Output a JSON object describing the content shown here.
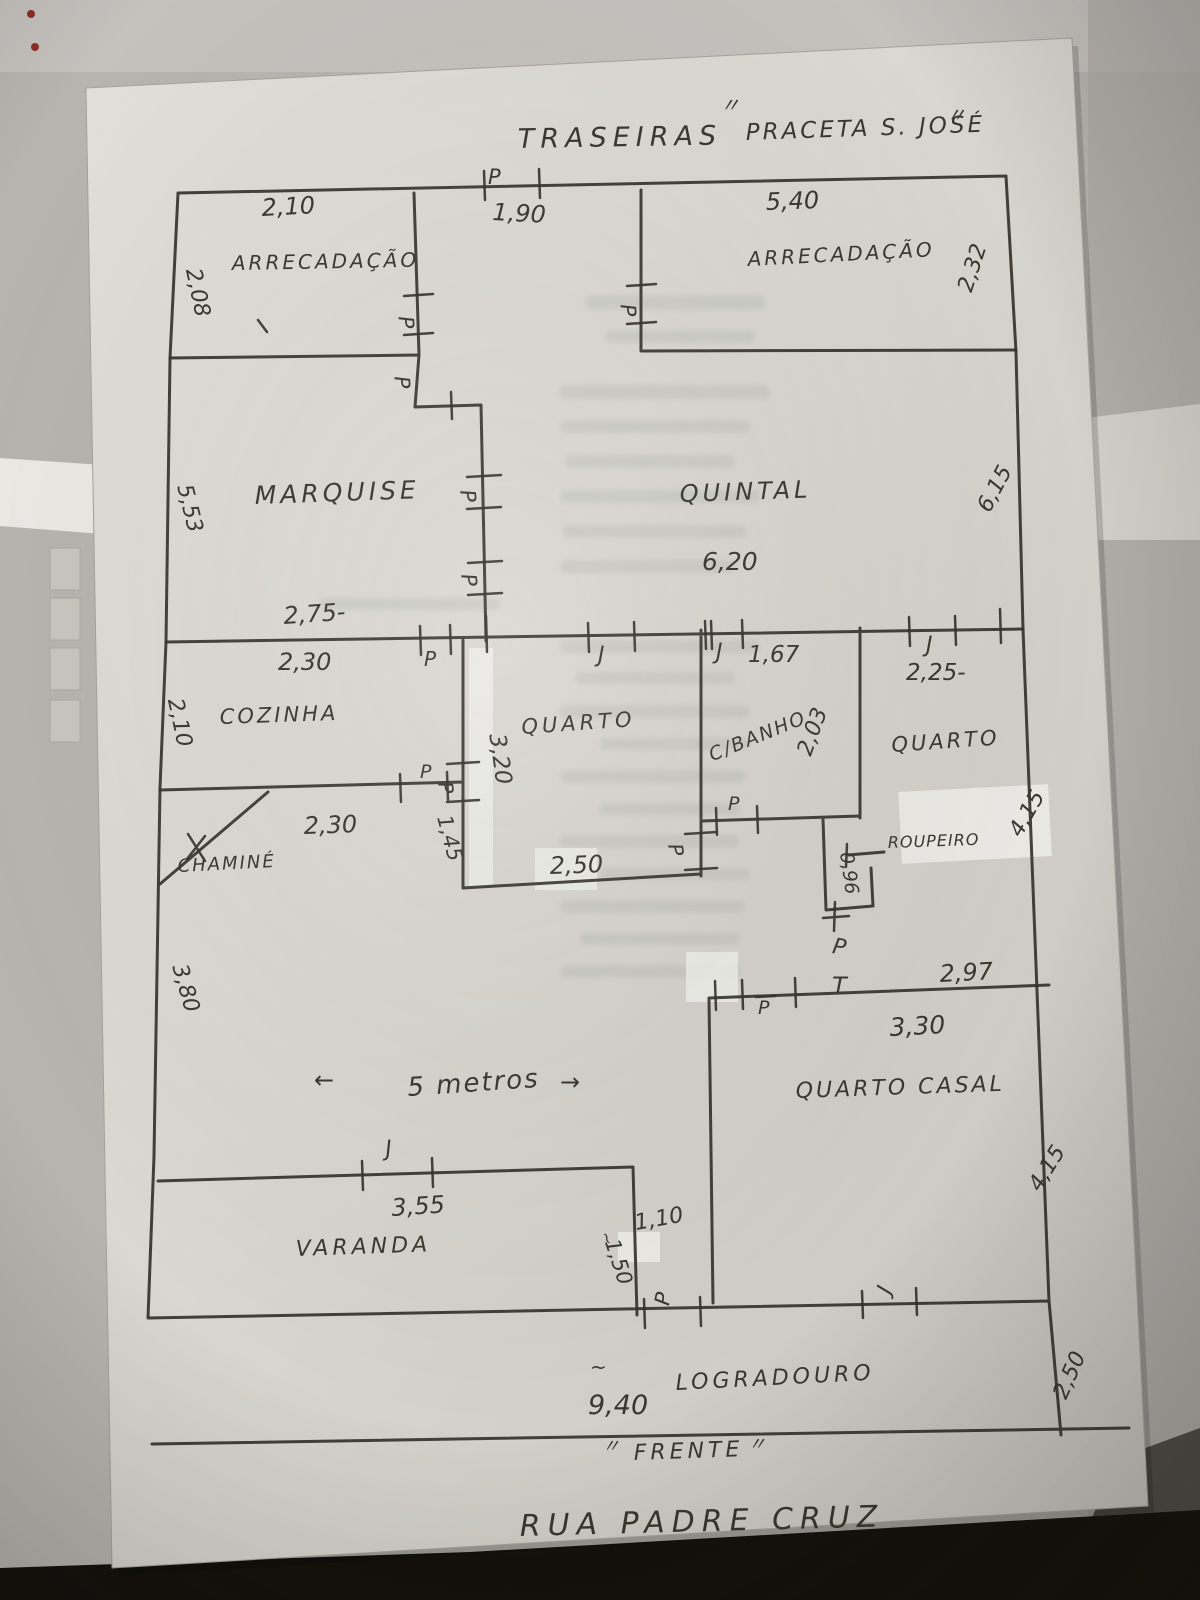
{
  "header": {
    "rear_label": "TRASEIRAS",
    "square_label": "PRACETA S. JOSÉ",
    "quote_mark": "〃"
  },
  "rooms": {
    "arrecadacao_left": "ARRECADAÇÃO",
    "arrecadacao_right": "ARRECADAÇÃO",
    "marquise": "MARQUISE",
    "quintal": "QUINTAL",
    "cozinha": "COZINHA",
    "chamine": "CHAMINÉ",
    "quarto_centro": "QUARTO",
    "c_banho": "C/BANHO",
    "quarto_direita": "QUARTO",
    "roupeiro": "ROUPEIRO",
    "quarto_casal": "QUARTO CASAL",
    "varanda": "VARANDA",
    "logradouro": "LOGRADOURO"
  },
  "dims": {
    "d210_top": "2,10",
    "d190": "1,90",
    "d540": "5,40",
    "d208": "2,08",
    "d232": "2,32",
    "d553": "5,53",
    "d615": "6,15",
    "d620": "6,20",
    "d275": "2,75-",
    "d230a": "2,30",
    "d210_left": "2,10",
    "d167": "1,67",
    "d203": "2,03",
    "d225": "2,25-",
    "d320": "3,20",
    "d230b": "2,30",
    "d145": "1,45",
    "d250a": "2,50",
    "d096": "0,96",
    "d415a": "4,15",
    "d297": "2,97",
    "d330": "3,30",
    "d380": "3,80",
    "five_meters": "5 metros",
    "d355": "3,55",
    "d150": "1,50",
    "d110": "1,10",
    "d415b": "4,15",
    "d940": "9,40",
    "d250b": "2,50"
  },
  "marks": {
    "door": "P",
    "window": "J",
    "tee": "T",
    "approx": "~",
    "arrow_left": "←",
    "arrow_right": "→"
  },
  "footer": {
    "front_label": "FRENTE",
    "quote_mark": "〃",
    "street": "RUA PADRE CRUZ"
  }
}
